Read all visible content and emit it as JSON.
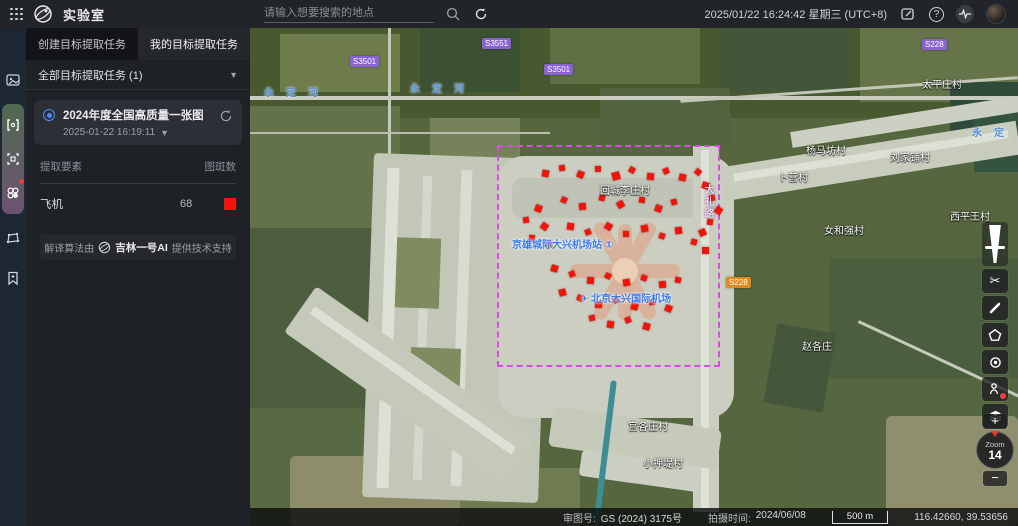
{
  "app": {
    "title": "实验室"
  },
  "topbar": {
    "search_placeholder": "请输入想要搜索的地点",
    "datetime": "2025/01/22 16:24:42 星期三 (UTC+8)",
    "icons": [
      "apps-grid",
      "app-logo",
      "search",
      "refresh",
      "note-edit",
      "help",
      "activity",
      "avatar"
    ]
  },
  "rail": {
    "icons": [
      "image-layer",
      "split-compare",
      "area-select",
      "target-detect",
      "polygon-draw",
      "bookmark-add"
    ],
    "badge_color": "#e8413c"
  },
  "panel": {
    "tabs": [
      {
        "label": "创建目标提取任务",
        "active": false
      },
      {
        "label": "我的目标提取任务",
        "active": true
      }
    ],
    "filter_label": "全部目标提取任务 (1)",
    "task": {
      "title": "2024年度全国高质量一张图",
      "datetime": "2025-01-22 16:19:11"
    },
    "table": {
      "col_element": "提取要素",
      "col_count": "图斑数",
      "rows": [
        {
          "name": "飞机",
          "count": "68",
          "color": "#f5120a"
        }
      ]
    },
    "credit": {
      "prefix": "解译算法由",
      "brand": "吉林一号AI",
      "suffix": "提供技术支持"
    }
  },
  "map": {
    "aoi": {
      "x": 247,
      "y": 117,
      "w": 223,
      "h": 222,
      "color": "#d44fe0"
    },
    "markers": {
      "color": "#f2140a",
      "points": [
        [
          292,
          142,
          7,
          10
        ],
        [
          309,
          137,
          6,
          -8
        ],
        [
          327,
          143,
          7,
          22
        ],
        [
          345,
          138,
          6,
          0
        ],
        [
          362,
          144,
          8,
          -15
        ],
        [
          379,
          139,
          6,
          30
        ],
        [
          397,
          145,
          7,
          5
        ],
        [
          413,
          140,
          6,
          -20
        ],
        [
          429,
          146,
          7,
          12
        ],
        [
          445,
          141,
          6,
          40
        ],
        [
          452,
          154,
          7,
          18
        ],
        [
          459,
          167,
          6,
          -12
        ],
        [
          465,
          179,
          7,
          33
        ],
        [
          457,
          191,
          6,
          8
        ],
        [
          449,
          201,
          7,
          -25
        ],
        [
          441,
          211,
          6,
          15
        ],
        [
          452,
          219,
          7,
          0
        ],
        [
          285,
          177,
          7,
          20
        ],
        [
          273,
          189,
          6,
          -10
        ],
        [
          291,
          195,
          7,
          35
        ],
        [
          279,
          207,
          6,
          5
        ],
        [
          295,
          213,
          7,
          -18
        ],
        [
          311,
          169,
          6,
          25
        ],
        [
          329,
          175,
          7,
          -5
        ],
        [
          349,
          167,
          6,
          15
        ],
        [
          367,
          173,
          7,
          -30
        ],
        [
          389,
          169,
          6,
          10
        ],
        [
          405,
          177,
          7,
          20
        ],
        [
          421,
          171,
          6,
          -15
        ],
        [
          317,
          195,
          7,
          8
        ],
        [
          335,
          201,
          6,
          -22
        ],
        [
          355,
          195,
          7,
          30
        ],
        [
          373,
          203,
          6,
          0
        ],
        [
          391,
          197,
          7,
          -12
        ],
        [
          409,
          205,
          6,
          18
        ],
        [
          425,
          199,
          7,
          -8
        ],
        [
          301,
          237,
          7,
          15
        ],
        [
          319,
          243,
          6,
          -20
        ],
        [
          337,
          249,
          7,
          5
        ],
        [
          355,
          245,
          6,
          28
        ],
        [
          373,
          251,
          7,
          -10
        ],
        [
          391,
          247,
          6,
          20
        ],
        [
          409,
          253,
          7,
          -5
        ],
        [
          425,
          249,
          6,
          12
        ],
        [
          309,
          261,
          7,
          -15
        ],
        [
          327,
          267,
          6,
          25
        ],
        [
          345,
          273,
          7,
          0
        ],
        [
          363,
          269,
          6,
          -28
        ],
        [
          381,
          275,
          7,
          14
        ],
        [
          399,
          271,
          6,
          -6
        ],
        [
          415,
          277,
          7,
          22
        ],
        [
          339,
          287,
          6,
          -12
        ],
        [
          357,
          293,
          7,
          8
        ],
        [
          375,
          289,
          6,
          -20
        ],
        [
          393,
          295,
          7,
          16
        ]
      ]
    },
    "labels": [
      {
        "text": "太平庄村",
        "x": 672,
        "y": 48,
        "type": "village"
      },
      {
        "text": "杨马坊村",
        "x": 556,
        "y": 114,
        "type": "village"
      },
      {
        "text": "刘家铺村",
        "x": 640,
        "y": 121,
        "type": "village"
      },
      {
        "text": "卜营村",
        "x": 528,
        "y": 141,
        "type": "village"
      },
      {
        "text": "回城李庄村",
        "x": 350,
        "y": 154,
        "type": "village"
      },
      {
        "text": "西平王村",
        "x": 700,
        "y": 180,
        "type": "village"
      },
      {
        "text": "女和强村",
        "x": 574,
        "y": 194,
        "type": "village"
      },
      {
        "text": "京雄城际大兴机场站 ①",
        "x": 262,
        "y": 208,
        "type": "poi"
      },
      {
        "text": "北京大兴国际机场",
        "x": 330,
        "y": 262,
        "type": "poi",
        "icon": "plane"
      },
      {
        "text": "宫各庄村",
        "x": 378,
        "y": 390,
        "type": "village"
      },
      {
        "text": "小押堤村",
        "x": 393,
        "y": 427,
        "type": "village"
      },
      {
        "text": "赵各庄",
        "x": 552,
        "y": 310,
        "type": "village"
      },
      {
        "text": "永定河",
        "x": 14,
        "y": 56,
        "type": "river",
        "spread": true
      },
      {
        "text": "永定河",
        "x": 160,
        "y": 52,
        "type": "river",
        "spread": true
      },
      {
        "text": "永定",
        "x": 722,
        "y": 96,
        "type": "river",
        "spread": true
      }
    ],
    "badges": [
      {
        "text": "S3501",
        "x": 100,
        "y": 28,
        "style": "purple"
      },
      {
        "text": "S3551",
        "x": 232,
        "y": 10,
        "style": "purple"
      },
      {
        "text": "S3501",
        "x": 294,
        "y": 36,
        "style": "purple"
      },
      {
        "text": "S228",
        "x": 672,
        "y": 11,
        "style": "purple"
      },
      {
        "text": "S228",
        "x": 476,
        "y": 249,
        "style": "orange"
      }
    ],
    "vertical_labels": [
      {
        "text": "大礼路",
        "x": 450,
        "y": 156
      }
    ]
  },
  "toolbar": {
    "buttons": [
      "swipe-opacity-slider",
      "clip-scissors",
      "measure-draw",
      "polygon-query",
      "locate",
      "poi-annotate",
      "layers",
      "zoom-in",
      "zoom-dial",
      "zoom-out"
    ],
    "zoom_label": "Zoom",
    "zoom_level": "14"
  },
  "statusbar": {
    "license_label": "审图号:",
    "license_value": "GS (2024) 3175号",
    "capture_label": "拍摄时间:",
    "capture_value": "2024/06/08",
    "scale_text": "500 m",
    "coordinates": "116.42660, 39.53656"
  }
}
